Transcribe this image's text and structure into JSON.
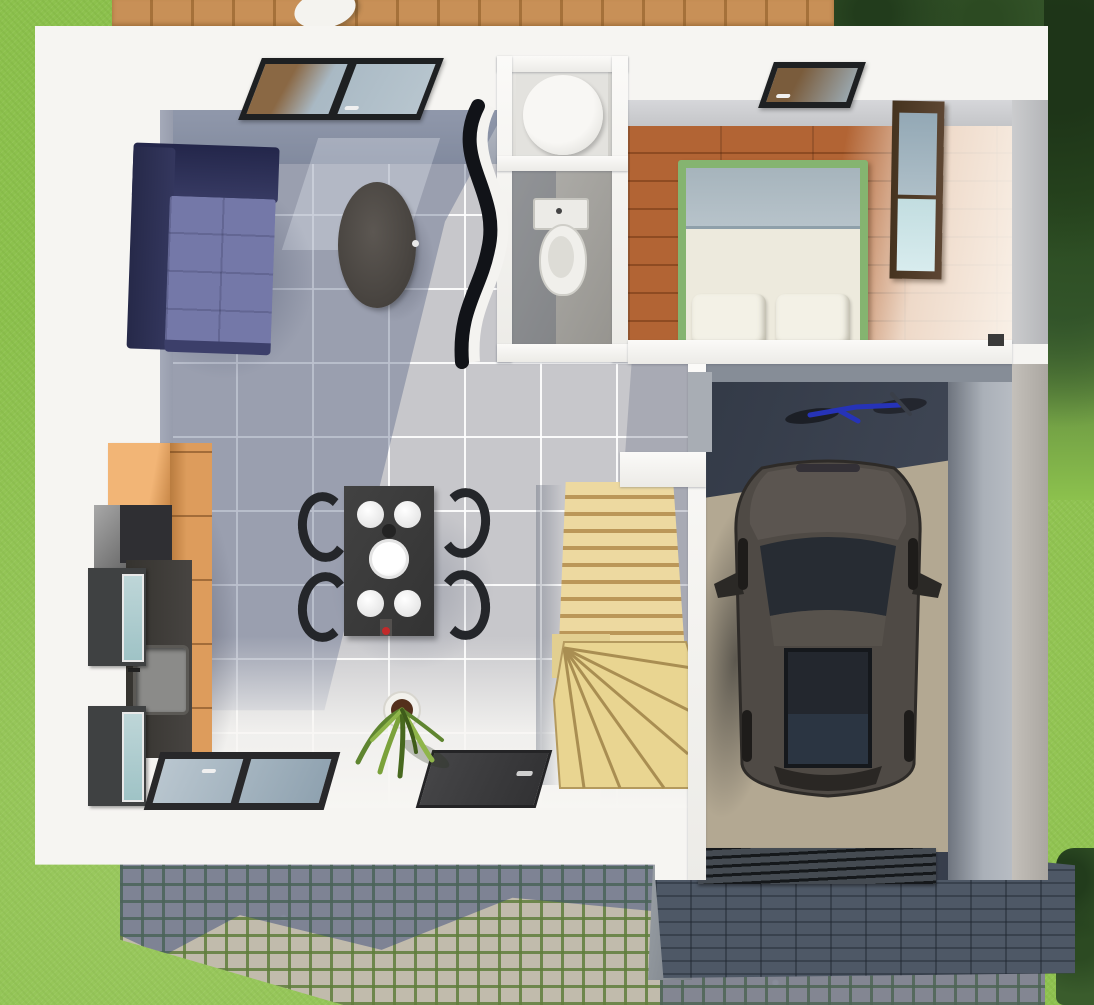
{
  "scene": {
    "type": "3d-floorplan-render",
    "view": "top-down bird's-eye",
    "aria": {
      "scene": "Top-down 3D rendering of a single-storey house floor plan with garage, garden, wood deck and cobblestone driveway",
      "garden": "Lawn with trees and bushes surrounding the house",
      "deck": "Wooden deck strip along the top edge of the house",
      "living_room": "Living room with navy corner sofa, oval coffee table and skylight window",
      "dining_area": "Dark dining table with four plates, centre bowl and four black chairs",
      "kitchen": "Kitchen corner with orange cabinets, grey appliances, dark countertop with sink and two glass-front wall cabinets",
      "bathroom": "Shower room with round shower cabin",
      "wc": "Separate toilet room with WC",
      "bedroom": "Bedroom with wooden plank floor, double bed with green frame, two pillows, mirrored wardrobe and skylight",
      "hallway": "Hallway with light wooden staircase with winder steps",
      "garage": "Garage with dark parked car, blue bicycle and concrete floor",
      "entry": "Front wall with entrance door, glazed window and potted plant",
      "driveway": "Cobblestone patio and driveway with grass joints",
      "garage_roof": "Dark tiled canopy roof over the garage entrance with slatted garage door"
    }
  },
  "palette": {
    "grass": "#8cc14d",
    "trees_dark": "#2c4a24",
    "deck_wood": "#c89057",
    "wall_white": "#f6f5f2",
    "inner_wall_gray": "#b6bbc5",
    "tile_floor": "#c7c7cb",
    "floor_shadow_blue": "#586484",
    "sofa_dark_navy": "#262949",
    "sofa_light_navy": "#7478a8",
    "coffee_table": "#45413d",
    "kitchen_cabinet_orange": "#dd9c5c",
    "kitchen_counter": "#35332f",
    "cabinet_glass": "#bed6d8",
    "dining_table": "#3a3a3a",
    "chair_black": "#24262a",
    "accent_red": "#c22a2a",
    "bedroom_wood": "#b26434",
    "bed_frame_green": "#85b470",
    "bed_linen": "#edeadd",
    "blanket_gray_blue": "#a6b4bc",
    "wardrobe_wood": "#5d4633",
    "mirror_blue": "#c2dde0",
    "stairs_wood": "#edd9a0",
    "garage_concrete_dark": "#3f4654",
    "garage_concrete_lit": "#b3a892",
    "car_body": "#4f4a45",
    "car_glass": "#272c33",
    "bicycle_blue": "#2633b8",
    "cobble_stone": "#c1bbac",
    "cobble_joint_green": "#607e3c",
    "cobble_shadow": "#34487a",
    "roof_tile": "#4e5866",
    "door_dark": "#3a3a3c",
    "skylight_frame": "#1e2022"
  },
  "inventory": {
    "skylight_windows": 2,
    "floor_level_windows": 1,
    "front_doors": 1,
    "corner_sofas": 1,
    "coffee_tables": 1,
    "dining_tables": 1,
    "dining_chairs": 4,
    "plates_on_table": 4,
    "centre_bowls": 1,
    "shower_cabins": 1,
    "toilets": 1,
    "beds": 1,
    "pillows": 2,
    "wardrobes": 1,
    "kitchen_wall_cabinets": 2,
    "staircases": 1,
    "cars": 1,
    "bicycles": 1,
    "potted_plants": 1
  }
}
